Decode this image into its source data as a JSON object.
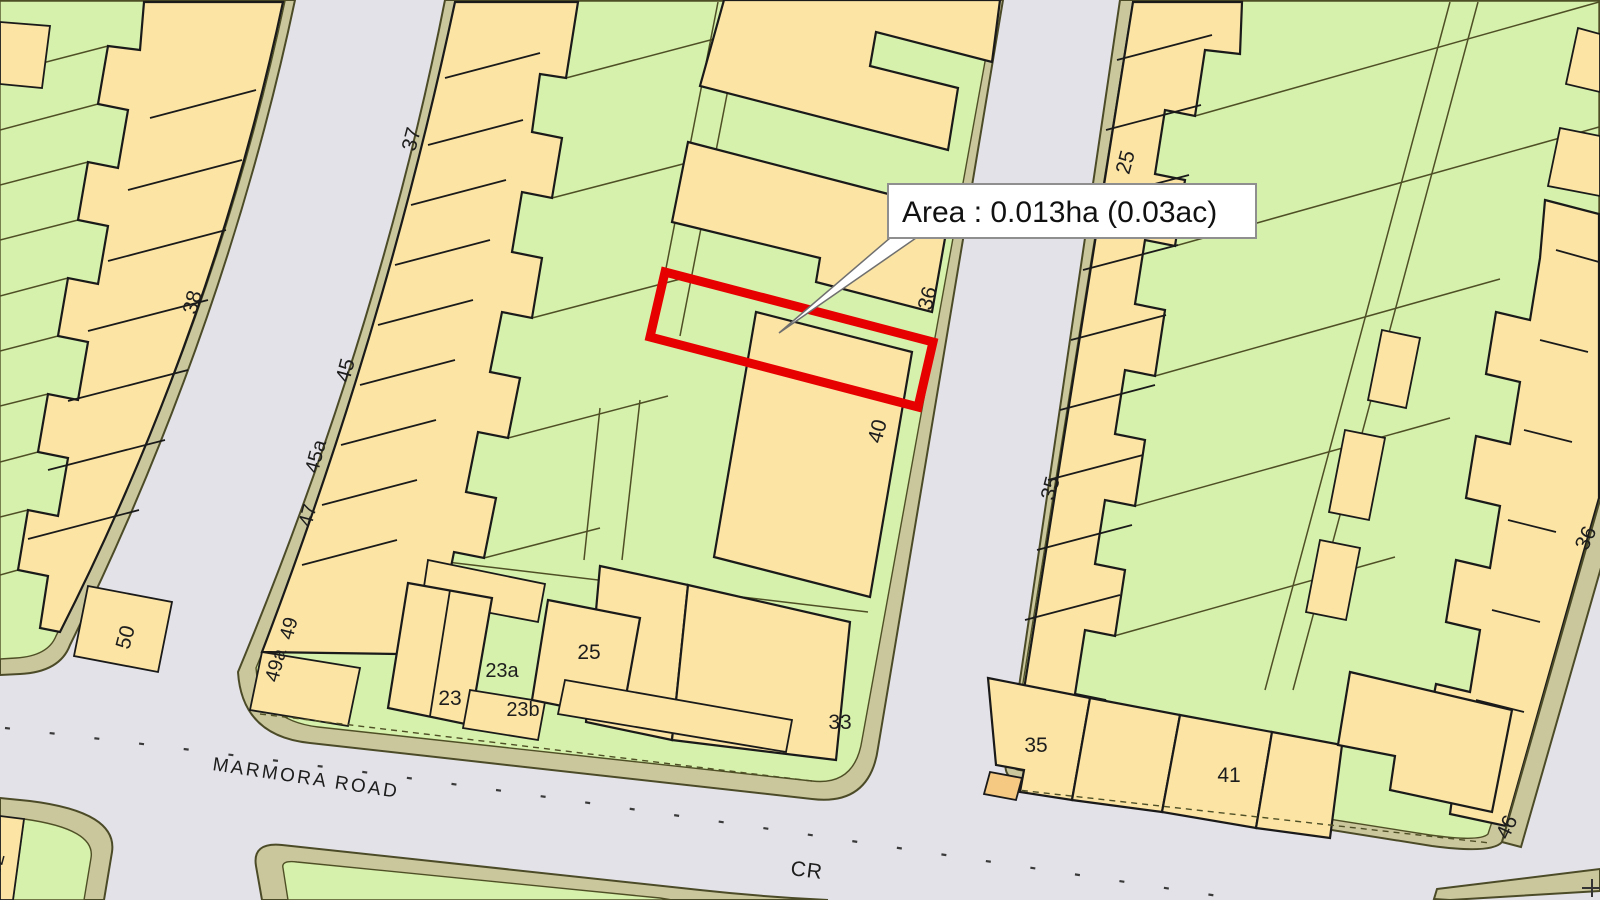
{
  "annotation": {
    "label": "Area : 0.013ha (0.03ac)"
  },
  "roads": {
    "primary_name": "MARMORA ROAD",
    "secondary_name": "CR"
  },
  "road_labels": [
    {
      "text": "MARMORA ROAD",
      "x": 212,
      "y": 770,
      "rot": 8.5,
      "size": 19,
      "spacing": 2.5,
      "anchor": "start"
    },
    {
      "text": "CR",
      "x": 806,
      "y": 877,
      "rot": 7,
      "size": 21,
      "spacing": 1,
      "anchor": "middle"
    }
  ],
  "plot_numbers": [
    {
      "text": "37",
      "x": 418,
      "y": 141,
      "rot": -75,
      "size": 21
    },
    {
      "text": "38",
      "x": 199,
      "y": 304,
      "rot": -75,
      "size": 21
    },
    {
      "text": "45",
      "x": 352,
      "y": 372,
      "rot": -75,
      "size": 21
    },
    {
      "text": "45a",
      "x": 322,
      "y": 458,
      "rot": -75,
      "size": 20
    },
    {
      "text": "47",
      "x": 314,
      "y": 517,
      "rot": -75,
      "size": 20
    },
    {
      "text": "49",
      "x": 295,
      "y": 630,
      "rot": -75,
      "size": 20
    },
    {
      "text": "49a",
      "x": 282,
      "y": 667,
      "rot": -75,
      "size": 20
    },
    {
      "text": "50",
      "x": 132,
      "y": 639,
      "rot": -75,
      "size": 21
    },
    {
      "text": "52",
      "x": 2,
      "y": 866,
      "rot": -75,
      "size": 20
    },
    {
      "text": "23",
      "x": 450,
      "y": 705,
      "rot": 0,
      "size": 21
    },
    {
      "text": "23a",
      "x": 502,
      "y": 677,
      "rot": 0,
      "size": 20
    },
    {
      "text": "23b",
      "x": 523,
      "y": 716,
      "rot": 0,
      "size": 20
    },
    {
      "text": "25",
      "x": 589,
      "y": 659,
      "rot": 0,
      "size": 21
    },
    {
      "text": "33",
      "x": 840,
      "y": 729,
      "rot": 0,
      "size": 21
    },
    {
      "text": "36",
      "x": 934,
      "y": 300,
      "rot": -75,
      "size": 21
    },
    {
      "text": "40",
      "x": 884,
      "y": 433,
      "rot": -75,
      "size": 21
    },
    {
      "text": "25",
      "x": 1132,
      "y": 164,
      "rot": -75,
      "size": 21
    },
    {
      "text": "35",
      "x": 1057,
      "y": 490,
      "rot": -75,
      "size": 21
    },
    {
      "text": "35",
      "x": 1036,
      "y": 752,
      "rot": 0,
      "size": 21
    },
    {
      "text": "41",
      "x": 1229,
      "y": 782,
      "rot": 0,
      "size": 21
    },
    {
      "text": "46",
      "x": 1513,
      "y": 830,
      "rot": -65,
      "size": 21
    },
    {
      "text": "36",
      "x": 1592,
      "y": 541,
      "rot": -65,
      "size": 21
    }
  ],
  "colors": {
    "garden_green": "#d6f1ab",
    "building_yellow": "#fbe4a4",
    "building_orange": "#f6c982",
    "road_grey": "#e3e2e8",
    "verge_khaki": "#cbc79d",
    "verge_outline": "#4c4b28",
    "building_outline": "#1a1a1a",
    "parcel_line": "#4f4f26",
    "highlight_red": "#e60000",
    "label_color": "#1d1d1d"
  }
}
